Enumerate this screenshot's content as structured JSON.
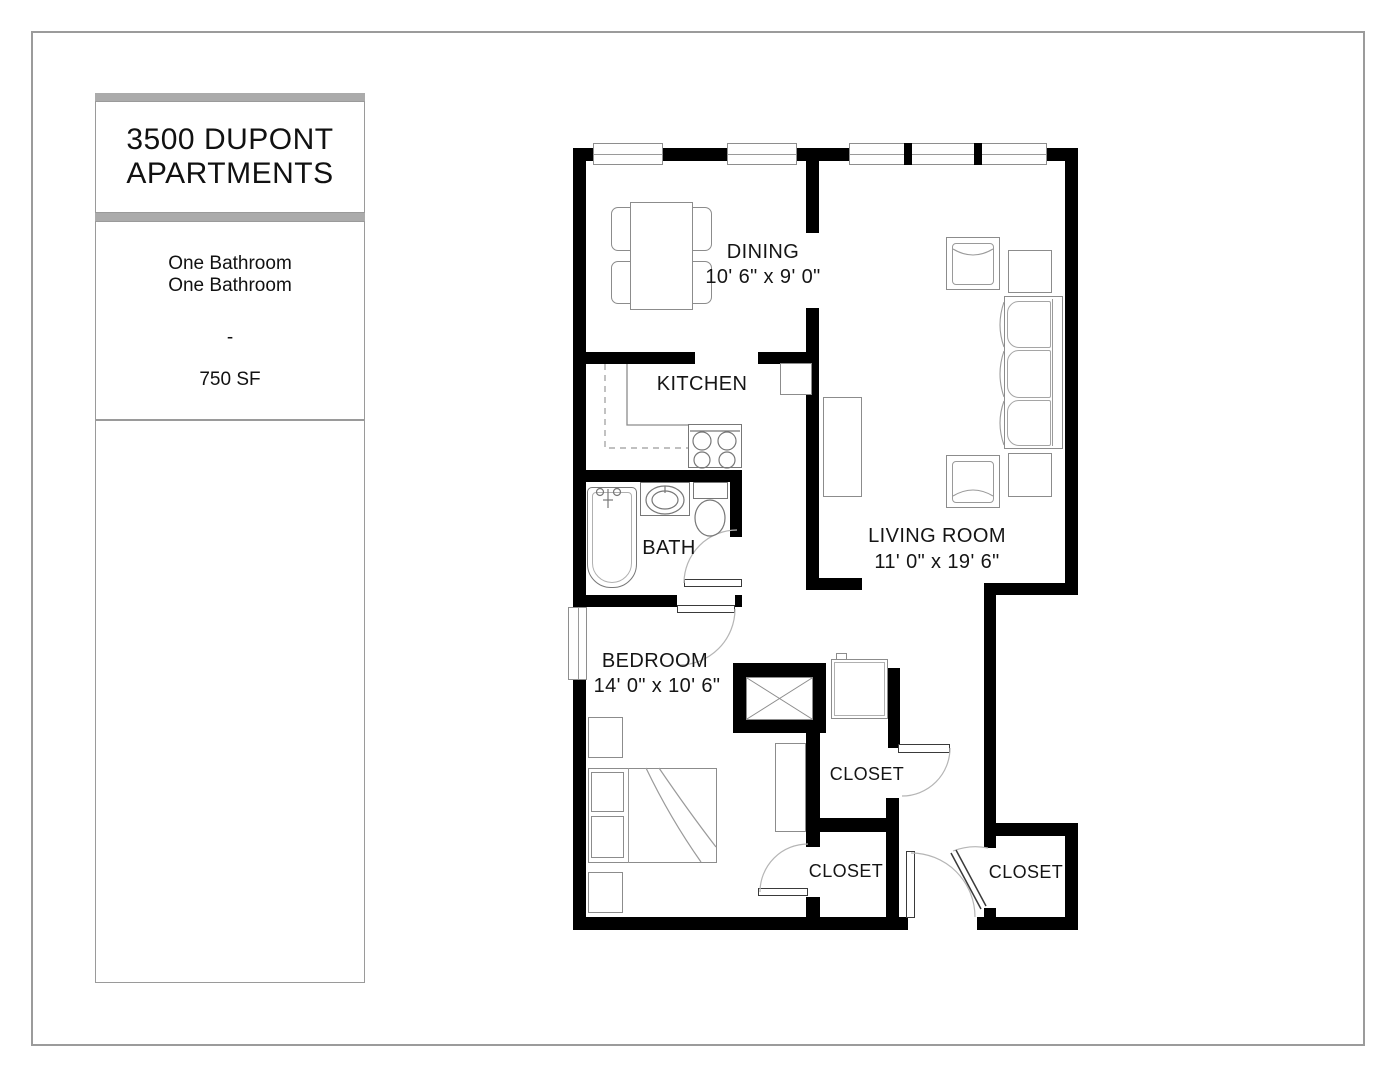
{
  "title_block": {
    "line1": "3500 DUPONT",
    "line2": "APARTMENTS",
    "info1": "One Bathroom",
    "info2": "One Bathroom",
    "sep": "-",
    "area": "750 SF"
  },
  "floor_plan": {
    "rooms": {
      "dining": {
        "name": "DINING",
        "dims": "10' 6\" x 9' 0\""
      },
      "kitchen": {
        "name": "KITCHEN"
      },
      "bath": {
        "name": "BATH"
      },
      "living": {
        "name": "LIVING ROOM",
        "dims": "11' 0\" x 19' 6\""
      },
      "bedroom": {
        "name": "BEDROOM",
        "dims": "14' 0\" x 10' 6\""
      },
      "closet_top": {
        "name": "CLOSET"
      },
      "closet_middle": {
        "name": "CLOSET"
      },
      "closet_entry": {
        "name": "CLOSET"
      }
    },
    "colors": {
      "wall": "#000000",
      "furniture_line": "#8c8c8c",
      "door_arc": "#b5b5b5",
      "panel_bar": "#ababab",
      "frame": "#9b9b9b"
    }
  }
}
